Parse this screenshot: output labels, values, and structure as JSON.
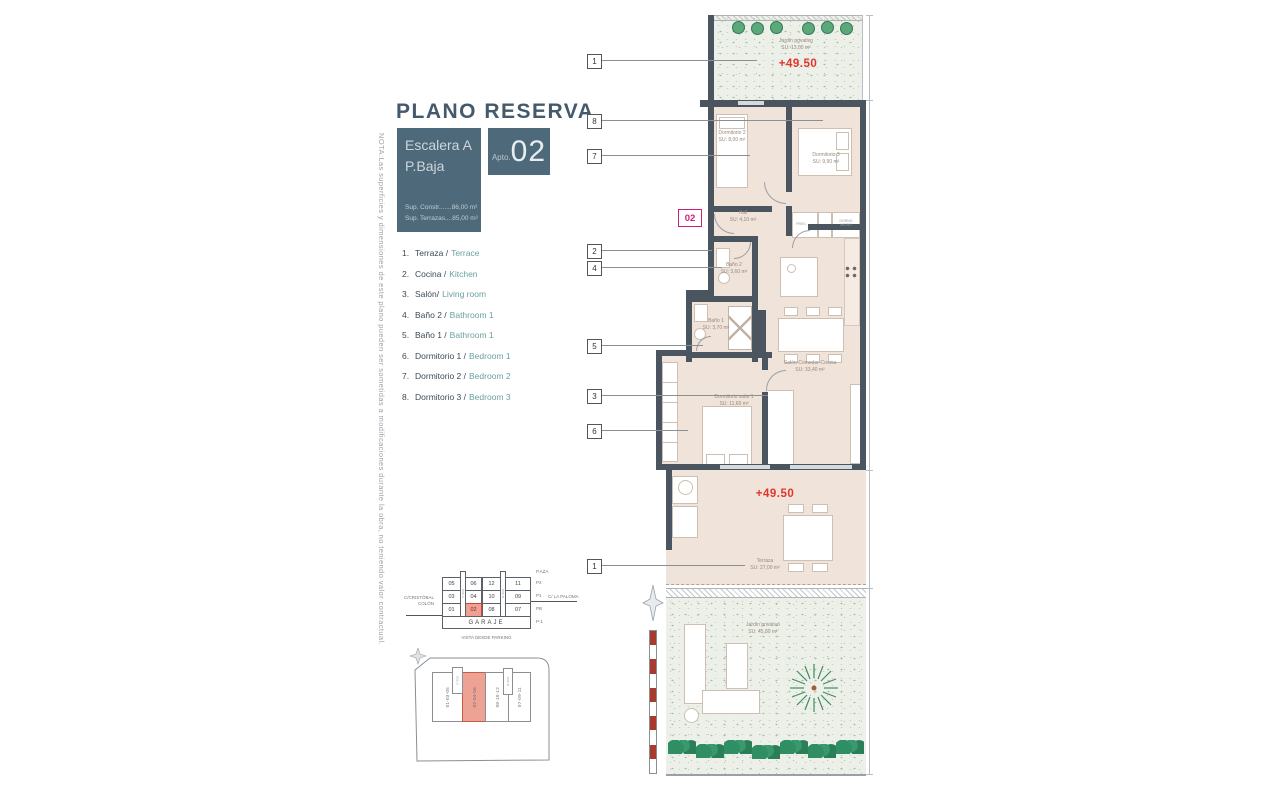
{
  "title": "PLANO RESERVA",
  "info": {
    "escalera": "Escalera A",
    "planta": "P.Baja",
    "sup1": "Sup. Constr.......86,00 m²",
    "sup2": "Sup. Terrazas....85,00 m²",
    "apto_label": "Apto.",
    "apto_num": "02"
  },
  "note": "NOTA:Las superficies y dimensiones de este plano pueden ser sometidas a modificaciones durante la obra, no teniendo valor contractual.",
  "legend": {
    "items": [
      {
        "n": "1.",
        "es": "Terraza /",
        "en": "Terrace"
      },
      {
        "n": "2.",
        "es": "Cocina /",
        "en": "Kitchen"
      },
      {
        "n": "3.",
        "es": "Salón/",
        "en": "Living room"
      },
      {
        "n": "4.",
        "es": "Baño 2 /",
        "en": "Bathroom 1"
      },
      {
        "n": "5.",
        "es": "Baño 1 /",
        "en": "Bathroom 1"
      },
      {
        "n": "6.",
        "es": "Dormitorio 1 /",
        "en": "Bedroom 1"
      },
      {
        "n": "7.",
        "es": "Dormitorio 2 /",
        "en": "Bedroom 2"
      },
      {
        "n": "8.",
        "es": "Dormitorio 3 /",
        "en": "Bedroom 3"
      }
    ]
  },
  "plan": {
    "badge": "02",
    "elevation_upper": "+49.50",
    "elevation_lower": "+49.50",
    "rooms": {
      "jardin_top": {
        "name": "Jardín privativo",
        "area": "SU: 13,00 m²"
      },
      "dorm2": {
        "name": "Dormitorio 2",
        "area": "SU: 8,00 m²"
      },
      "dorm3": {
        "name": "Dormitorio 3",
        "area": "SU: 9,90 m²"
      },
      "hall": {
        "name": "Hall",
        "area": "SU: 4,10 m²"
      },
      "bano2": {
        "name": "Baño 2",
        "area": "SU: 3,60 m²"
      },
      "bano1": {
        "name": "Baño 1",
        "area": "SU: 3,70 m²"
      },
      "salon": {
        "name": "Salón-Comedor-Cocina",
        "area": "SU: 33,40 m²"
      },
      "suite": {
        "name": "Dormitorio suite 1",
        "area": "SU: 11,60 m²"
      },
      "terraza": {
        "name": "Terraza",
        "area": "SU: 27,00 m²"
      },
      "jardin_bottom": {
        "name": "Jardín privativo",
        "area": "SU: 45,80 m²"
      }
    },
    "appliances": {
      "freg": "FREG.",
      "horno": "HORNO MICRO"
    },
    "callouts": [
      "1",
      "8",
      "7",
      "2",
      "4",
      "5",
      "3",
      "6",
      "1"
    ]
  },
  "stack": {
    "rows": [
      [
        "05",
        "06",
        "12",
        "11"
      ],
      [
        "03",
        "04",
        "10",
        "09"
      ],
      [
        "01",
        "02",
        "08",
        "07"
      ]
    ],
    "garage": "GARAJE",
    "floors": [
      "P.AZA",
      "P2",
      "P1",
      "PB",
      "P-1"
    ],
    "street_left1": "C/CRISTÓBAL",
    "street_left2": "COLÓN",
    "street_right": "C/ LA PALOMA",
    "caption": "VISTA DESDE PARKING",
    "esc_a": "ESC.A",
    "esc_b": "ESC.B"
  },
  "site": {
    "strips": [
      "01-03-05",
      "02-04-06",
      "08-10-12",
      "07-09-11"
    ],
    "esc_a": "ESC.A",
    "esc_b": "ESC.B"
  },
  "colors": {
    "slate": "#4e6a7a",
    "wall": "#4b555f",
    "red": "#e2342b",
    "magenta": "#cc1f7b",
    "teal": "#6ba0a0",
    "floor": "#f0e3da",
    "highlight": "#f0a091"
  }
}
